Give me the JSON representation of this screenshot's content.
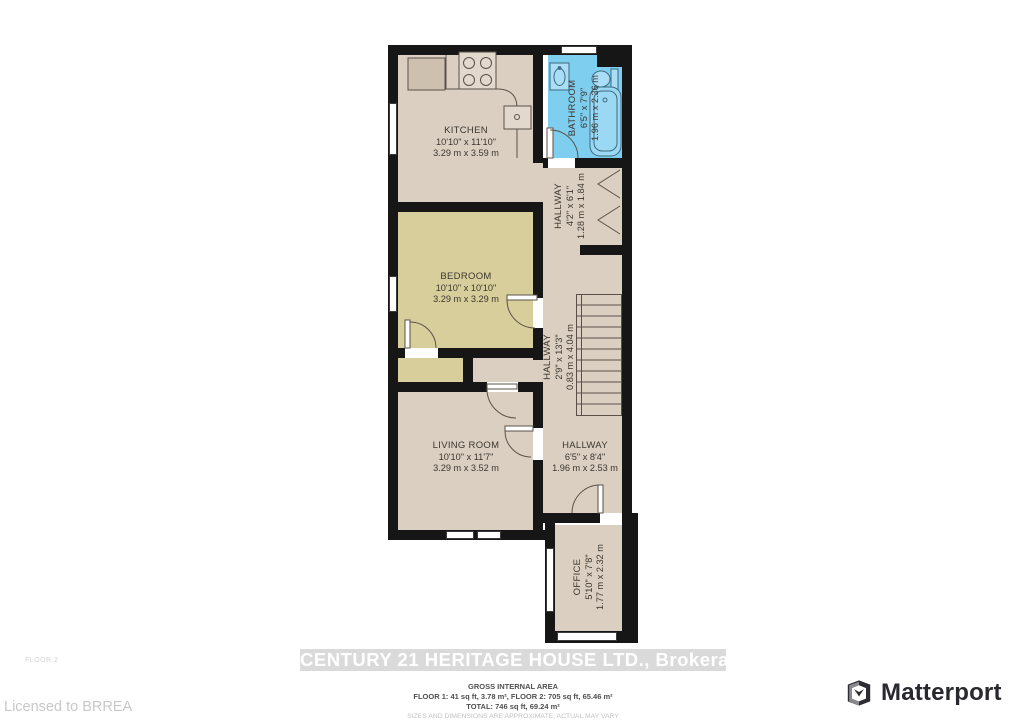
{
  "floorplan": {
    "rooms": [
      {
        "id": "kitchen",
        "name": "KITCHEN",
        "dims_ft": "10'10\" x 11'10\"",
        "dims_m": "3.29 m x 3.59 m"
      },
      {
        "id": "bathroom",
        "name": "BATHROOM",
        "dims_ft": "6'5\" x 7'9\"",
        "dims_m": "1.96 m x 2.36 m"
      },
      {
        "id": "hallway-upper",
        "name": "HALLWAY",
        "dims_ft": "4'2\" x 6'1\"",
        "dims_m": "1.28 m x 1.84 m"
      },
      {
        "id": "bedroom",
        "name": "BEDROOM",
        "dims_ft": "10'10\" x 10'10\"",
        "dims_m": "3.29 m x 3.29 m"
      },
      {
        "id": "hallway-stairs",
        "name": "HALLWAY",
        "dims_ft": "2'9\" x 13'3\"",
        "dims_m": "0.83 m x 4.04 m"
      },
      {
        "id": "living-room",
        "name": "LIVING ROOM",
        "dims_ft": "10'10\" x 11'7\"",
        "dims_m": "3.29 m x 3.52 m"
      },
      {
        "id": "hallway-lower",
        "name": "HALLWAY",
        "dims_ft": "6'5\" x 8'4\"",
        "dims_m": "1.96 m x 2.53 m"
      },
      {
        "id": "office",
        "name": "OFFICE",
        "dims_ft": "5'10\" x 7'8\"",
        "dims_m": "1.77 m x 2.32 m"
      }
    ],
    "colors": {
      "wall": "#161616",
      "room_default": "#DBCFC2",
      "bedroom_fill": "#D8CE9C",
      "bathroom_fill": "#7DCEEF",
      "fixture_outline": "#5a5248",
      "bath_fixture_outline": "#3E6A80",
      "banner_bg": "#DADADA",
      "banner_text": "#FFFFFF"
    }
  },
  "footer": {
    "brokerage": "CENTURY 21 HERITAGE HOUSE LTD., Brokerage",
    "floor_label": "FLOOR 2",
    "area_title": "GROSS INTERNAL AREA",
    "area_line1": "FLOOR 1: 41 sq ft, 3.78 m², FLOOR 2: 705 sq ft, 65.46 m²",
    "area_line2": "TOTAL: 746 sq ft, 69.24 m²",
    "disclaimer": "SIZES AND DIMENSIONS ARE APPROXIMATE, ACTUAL MAY VARY",
    "license": "Licensed to BRREA",
    "matterport_label": "Matterport"
  }
}
